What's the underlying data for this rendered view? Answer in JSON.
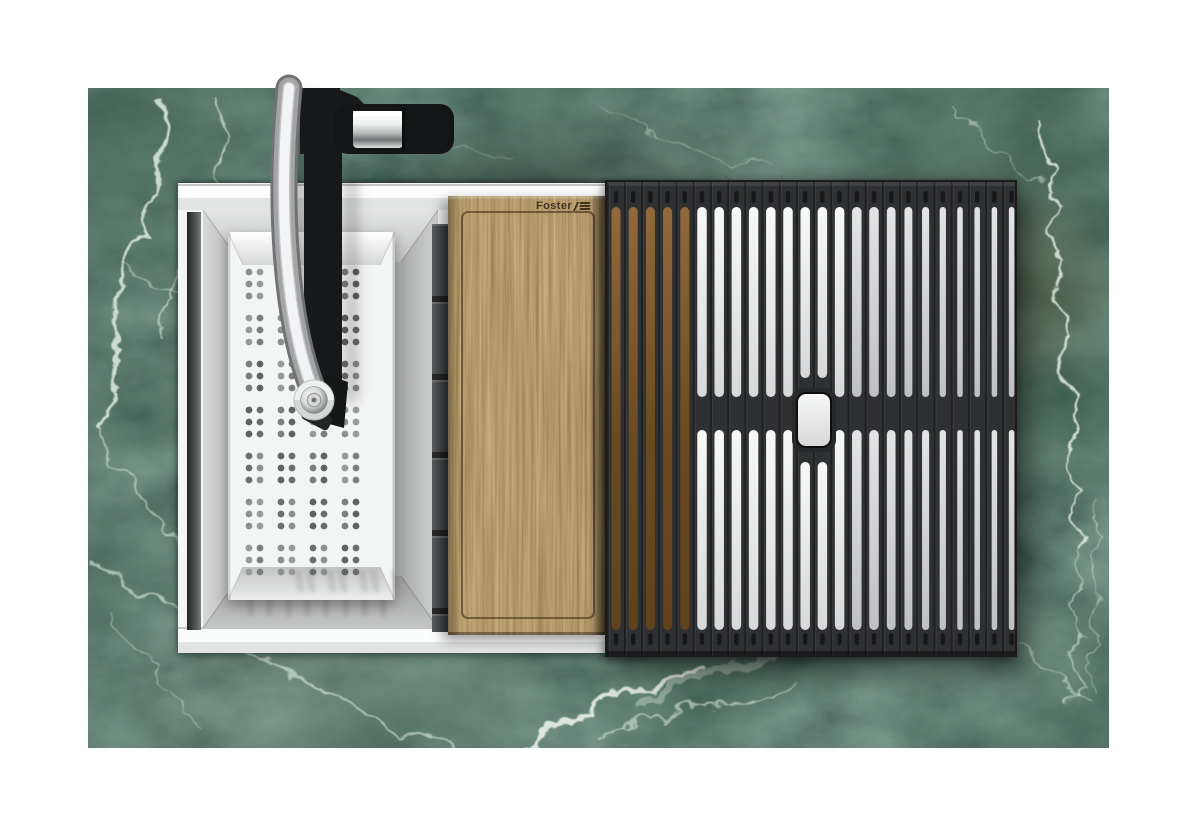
{
  "image": {
    "kind": "top-view product render",
    "subject": "Foster workstation kitchen sink with colander, walnut cutting board and black folding grid, set in a green marble countertop"
  },
  "brand": {
    "name": "Foster",
    "logo_icon": "foster-logo-icon"
  },
  "palette": {
    "page_bg": "#ffffff",
    "marble_base": "#1d332a",
    "marble_mid": "#3a5547",
    "marble_dark": "#0f1d16",
    "marble_vein": "#d9e7da",
    "marble_vein_bright": "#eff6ef",
    "frame_white": "#f4f5f5",
    "frame_shade": "#e2e4e4",
    "frame_line": "#c3c6c5",
    "steel_light": "#e4e5e5",
    "steel_mid": "#bfc0c0",
    "steel_dark": "#9b9c9c",
    "colander_white": "#f3f4f4",
    "hole_grays": [
      "#8d8f90",
      "#7b7d7e",
      "#6a6c6d",
      "#97999a",
      "#5f6162"
    ],
    "ledge_gray": "#47494b",
    "wood_light": "#97713d",
    "wood_mid": "#7a5729",
    "wood_dark": "#4e3517",
    "wood_groove": "#35250e",
    "brand_ink": "#2e2310",
    "mat_body": "#2f3032",
    "mat_dark": "#1a1b1c",
    "slot_bright_top": "#f7f8f8",
    "slot_bright_bottom": "#d7d8d9",
    "slot_dim_top": "#e3e4e5",
    "slot_dim_bottom": "#bfc0c2",
    "slot_wood_top": "#91693a",
    "slot_wood_bottom": "#5f421d",
    "chrome_light": "#f0f1f1",
    "chrome_mid": "#b5b7b8",
    "chrome_dark": "#707274",
    "faucet_black": "#17181a"
  },
  "colander_pattern": {
    "hole_column_groups": 4,
    "columns_per_group": 2,
    "row_groups": 7,
    "rows_per_group": 3
  },
  "mat_pattern": {
    "columns": 24,
    "wood_backed_columns": 5,
    "split_rows_in_right_section": 2,
    "has_center_handle": true
  },
  "parts": [
    {
      "name": "marble-countertop"
    },
    {
      "name": "sink-frame"
    },
    {
      "name": "sink-bowl"
    },
    {
      "name": "colander-insert"
    },
    {
      "name": "faucet"
    },
    {
      "name": "accessory-ledge"
    },
    {
      "name": "cutting-board"
    },
    {
      "name": "rolling-grid-mat"
    }
  ]
}
